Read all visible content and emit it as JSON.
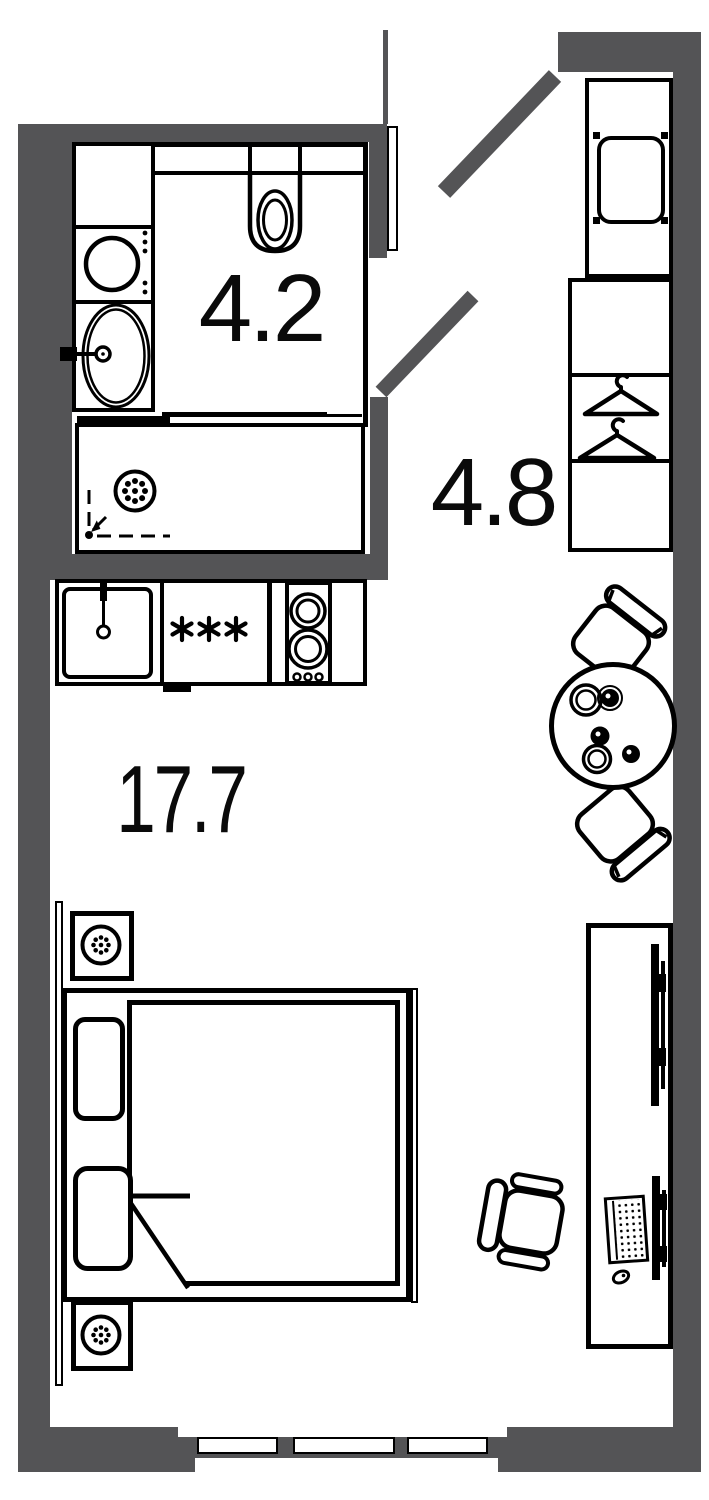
{
  "page": {
    "type": "floor-plan"
  },
  "colors": {
    "wall": "#545456",
    "line": "#000000",
    "background": "#ffffff",
    "text": "#0a0a0a"
  },
  "rooms": [
    {
      "id": "bathroom",
      "area_label": "4.2"
    },
    {
      "id": "hallway",
      "area_label": "4.8"
    },
    {
      "id": "living-kitchen",
      "area_label": "17.7"
    }
  ],
  "icons": {
    "washing-machine-icon": "circle-drum-with-dots",
    "bathroom-sink-icon": "oval-basin-with-faucet",
    "toilet-icon": "wall-hung-bowl",
    "shower-drain-icon": "dotted-circle",
    "shower-entry-arrow-icon": "dashed-corner-arrow",
    "kitchen-sink-icon": "rounded-square-basin",
    "burner-asterisk-icon": "✳",
    "stove-burners-icon": "double-ring-circles",
    "hanger-icon": "triangle-with-hook",
    "stool-icon": "rounded-rect-with-feet",
    "dining-table-icon": "circle-with-plates-and-cups",
    "dining-chair-icon": "seat-with-backrest",
    "office-chair-icon": "seat-with-armrests",
    "bed-icon": "frame-mattress-pillows",
    "blanket-fold-icon": "folded-corner-triangle",
    "nightstand-plant-icon": "dotted-plant-circle",
    "tv-icon": "wall-mounted-bar",
    "monitor-icon": "wall-mounted-bar",
    "keyboard-icon": "dot-grid",
    "mouse-icon": "small-oval",
    "entrance-door-icon": "diagonal-door-leaf",
    "interior-door-icon": "diagonal-door-leaf",
    "window-icon": "triple-sash-window"
  }
}
